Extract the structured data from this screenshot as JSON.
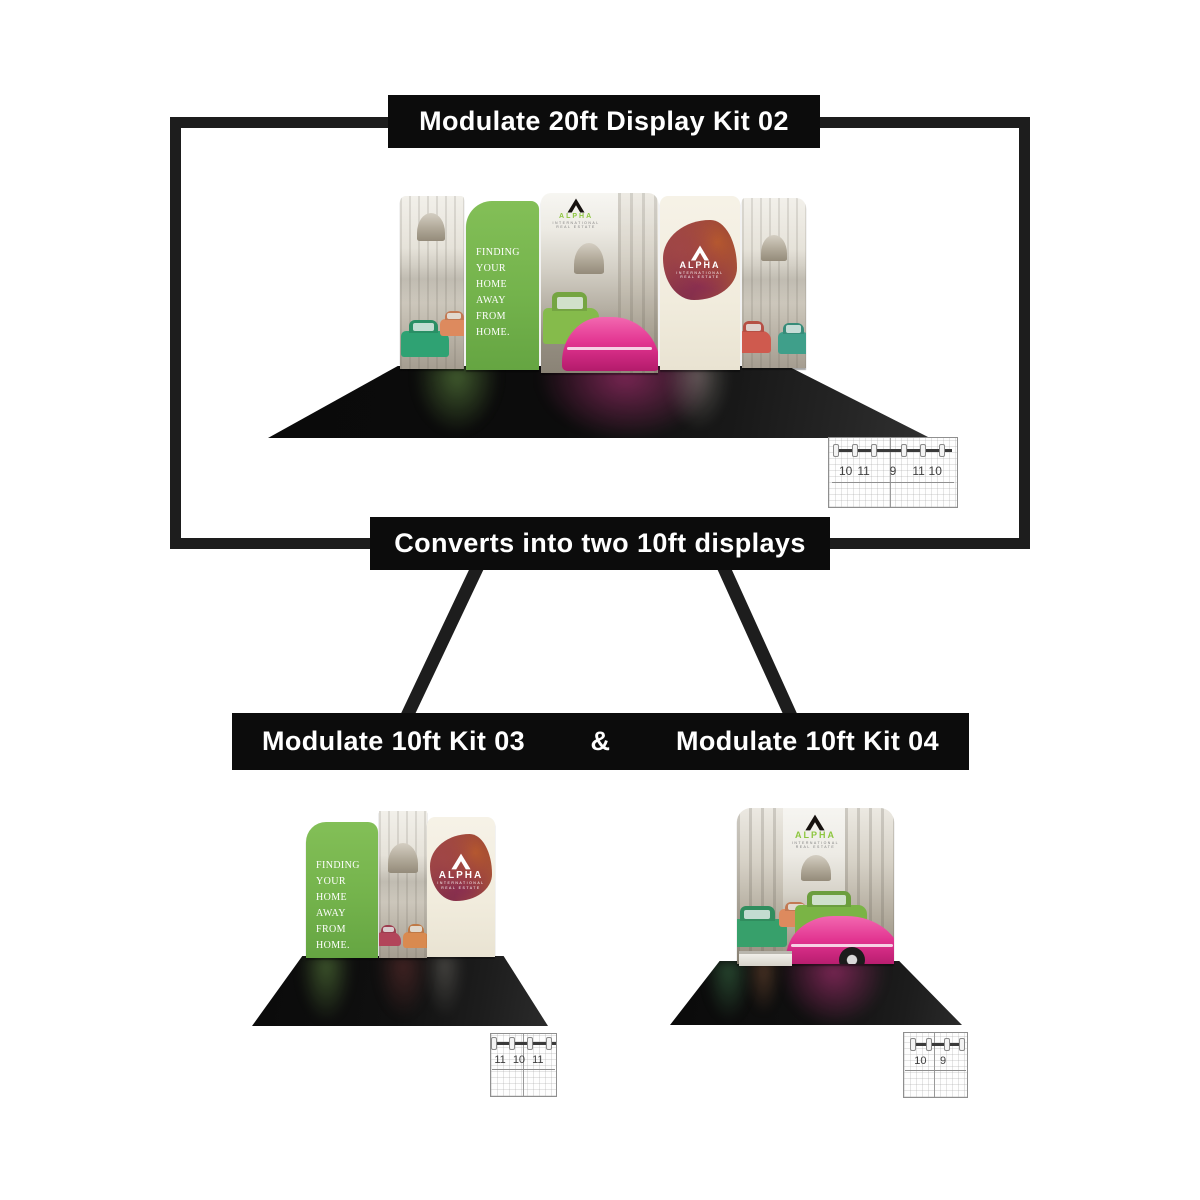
{
  "banners": {
    "top": "Modulate 20ft Display Kit 02",
    "middle": "Converts into two 10ft displays",
    "kit03": "Modulate 10ft Kit 03",
    "amp": "&",
    "kit04": "Modulate 10ft Kit 04"
  },
  "graphics": {
    "green_panel_text": "FINDING\nYOUR HOME\nAWAY FROM\nHOME.",
    "alpha_brand": "ALPHA",
    "alpha_sub1": "INTERNATIONAL",
    "alpha_sub2": "REAL ESTATE"
  },
  "diagrams": {
    "kit02": {
      "numbers": [
        "10",
        "11",
        "9",
        "11",
        "10"
      ]
    },
    "kit03": {
      "numbers": [
        "11",
        "10",
        "11"
      ]
    },
    "kit04": {
      "numbers": [
        "10",
        "9"
      ]
    }
  },
  "colors": {
    "banner_bg": "#0c0c0c",
    "banner_text": "#ffffff",
    "frame": "#1d1d1d",
    "accent_green": "#74b34c",
    "accent_pink": "#e23390",
    "logo_green": "#8dc63f"
  }
}
